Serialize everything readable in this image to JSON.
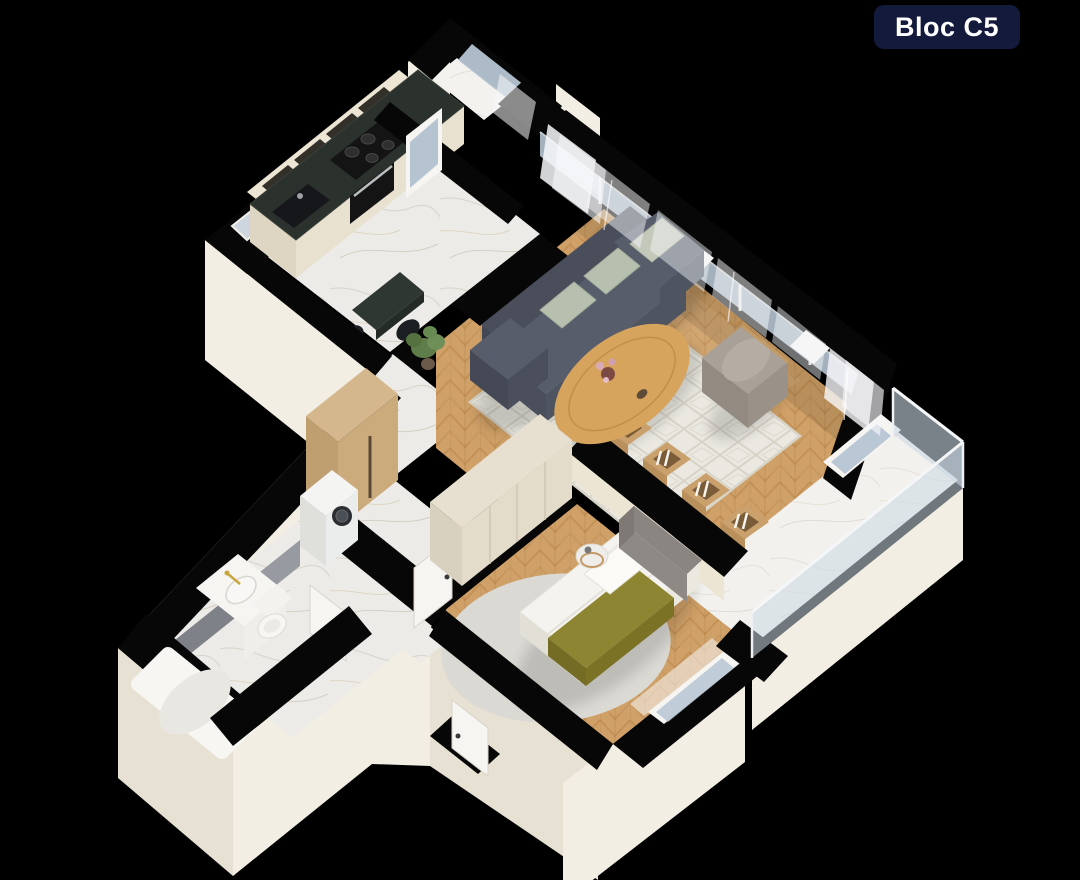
{
  "badge": {
    "label": "Bloc C5",
    "bg": "#141a3c",
    "text_color": "#ffffff"
  },
  "canvas": {
    "width": 1080,
    "height": 880,
    "background": "#000000"
  },
  "palette": {
    "wall_top": "#070707",
    "face_light": "#f2eee4",
    "face_shade": "#e7e1d3",
    "inner_cream": "#ece5d4",
    "marble": "#edebe7",
    "marble_vein": "#d8d3c8",
    "wood": "#cfa067",
    "wood_line": "#b9854a",
    "glass": "#b6c4d2",
    "curtain": "#f7f8fa",
    "rail_glass": "#ccd9e4",
    "sofa": "#575d6b",
    "sofa_dark": "#494e5a",
    "pillow": "#b7bfae",
    "rug": "#eae8e1",
    "rug_line": "#d5d1c4",
    "table_wood": "#d7a45e",
    "armchair": "#a9a098",
    "bed_white": "#f5f3ef",
    "olive": "#8d8531",
    "headboard": "#8e8984",
    "wardrobe": "#e7e0d0",
    "tan": "#d5b78d",
    "counter": "#2b312c",
    "appliance": "#141414",
    "tile": "#7e8288",
    "tile_light": "#979ba1",
    "gold": "#c9a53f",
    "fixture": "#f6f5f2",
    "plant": "#5f7c4b",
    "orange": "#c96a3c"
  },
  "scene": {
    "type": "3d-isometric-apartment-floor-plan",
    "rooms": [
      {
        "name": "kitchen",
        "floor": "marble",
        "furniture": [
          "cabinets",
          "countertop",
          "gas-hob",
          "oven",
          "sink",
          "open-shelves",
          "bar-table",
          "chairs"
        ]
      },
      {
        "name": "kitchen-balcony",
        "floor": "marble",
        "features": [
          "parapet-wall",
          "glazing",
          "curtain"
        ]
      },
      {
        "name": "living-room",
        "floor": "herringbone-wood",
        "furniture": [
          "corner-sofa",
          "cushions",
          "coffee-table",
          "area-rug",
          "armchair",
          "media-console",
          "books",
          "sheer-curtains",
          "floor-pouf",
          "plant"
        ]
      },
      {
        "name": "hallway",
        "floor": "marble",
        "furniture": [
          "wardrobe",
          "washing-machine",
          "interior-doors"
        ]
      },
      {
        "name": "bathroom",
        "floor": "marble",
        "furniture": [
          "bathtub",
          "vanity-sink",
          "toilet",
          "tiled-wall"
        ]
      },
      {
        "name": "bedroom",
        "floor": "herringbone-wood",
        "furniture": [
          "double-bed",
          "headboard",
          "pillows",
          "olive-bedspread",
          "wardrobe",
          "round-rug",
          "bedside-table",
          "window-curtain"
        ]
      },
      {
        "name": "balcony",
        "floor": "marble",
        "features": [
          "glass-railing"
        ]
      }
    ]
  }
}
